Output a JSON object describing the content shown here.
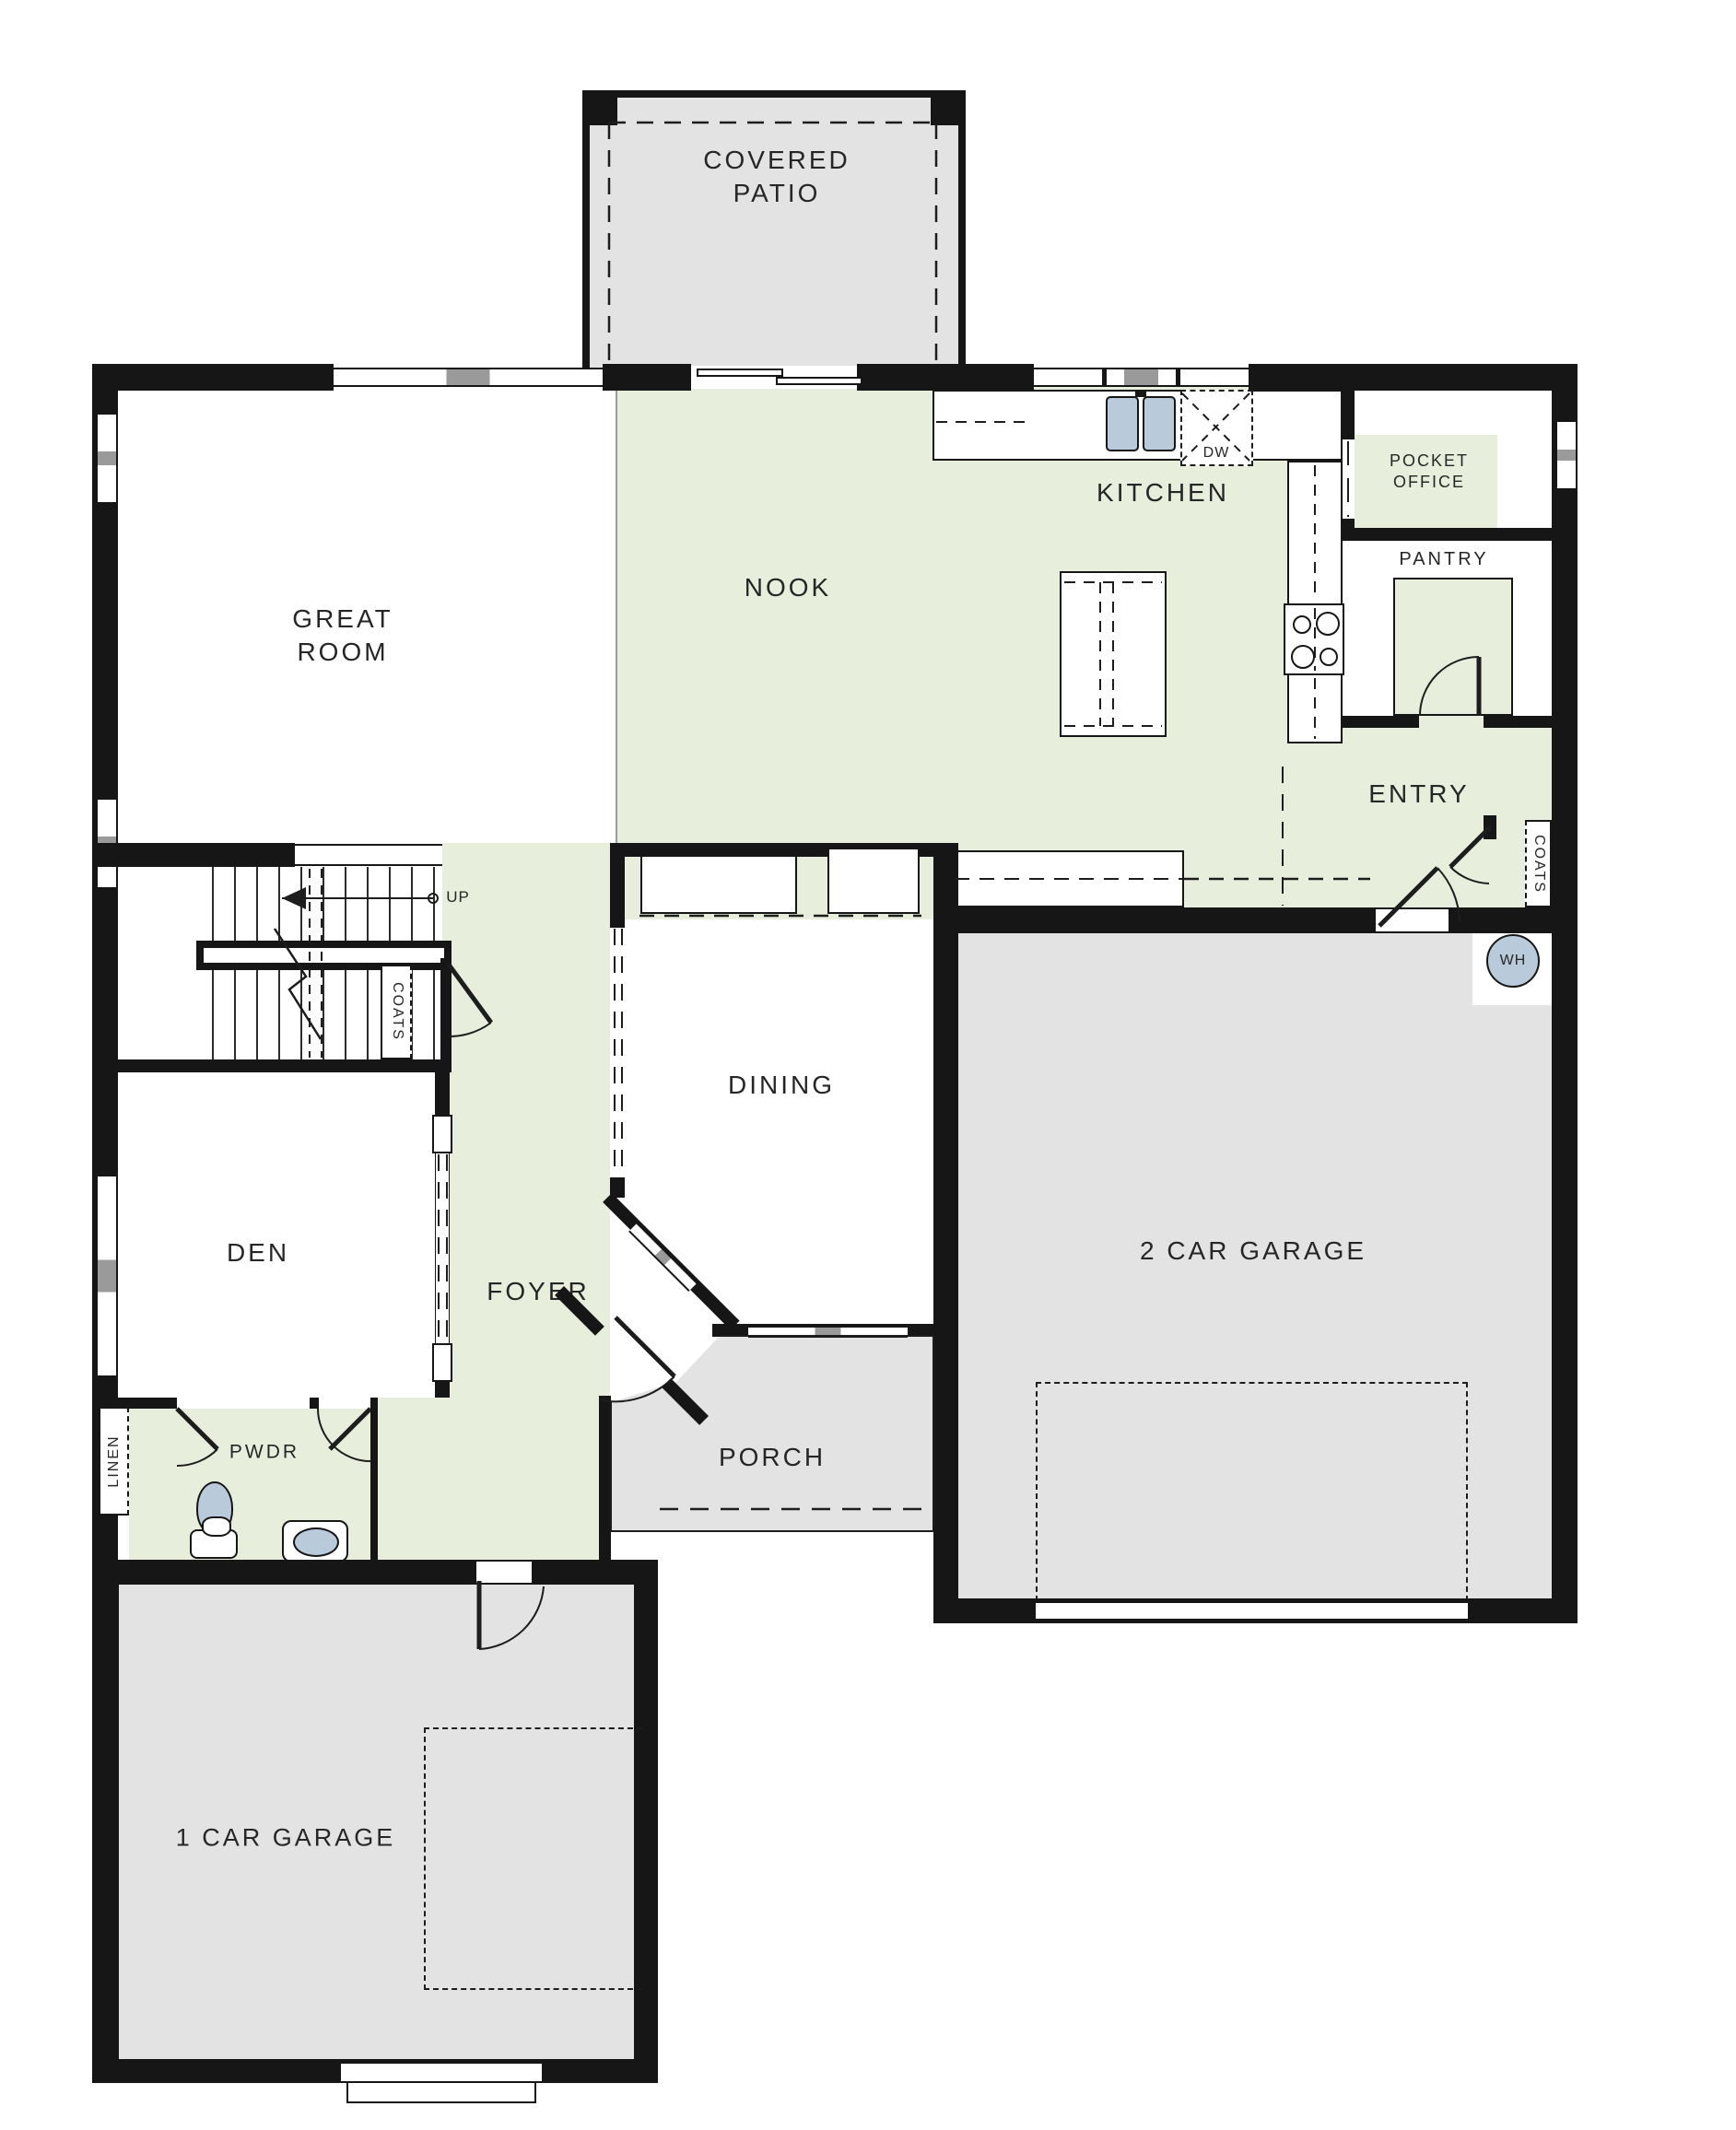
{
  "plan": {
    "type": "floor-plan",
    "colors": {
      "living_area_green": "#e7efdc",
      "garage_patio_gray": "#e3e3e3",
      "wall_black": "#161616",
      "fixture_blue": "#b9cada"
    },
    "labels": {
      "covered_patio": "COVERED\nPATIO",
      "great_room": "GREAT\nROOM",
      "nook": "NOOK",
      "kitchen": "KITCHEN",
      "pocket_office": "POCKET\nOFFICE",
      "pantry": "PANTRY",
      "entry": "ENTRY",
      "dining": "DINING",
      "den": "DEN",
      "foyer": "FOYER",
      "pwdr": "PWDR",
      "porch": "PORCH",
      "garage_two_car": "2 CAR GARAGE",
      "garage_one_car": "1 CAR GARAGE",
      "coats_stair": "COATS",
      "coats_entry": "COATS",
      "linen": "LINEN",
      "up": "UP",
      "dishwasher": "DW",
      "water_heater": "WH"
    }
  }
}
